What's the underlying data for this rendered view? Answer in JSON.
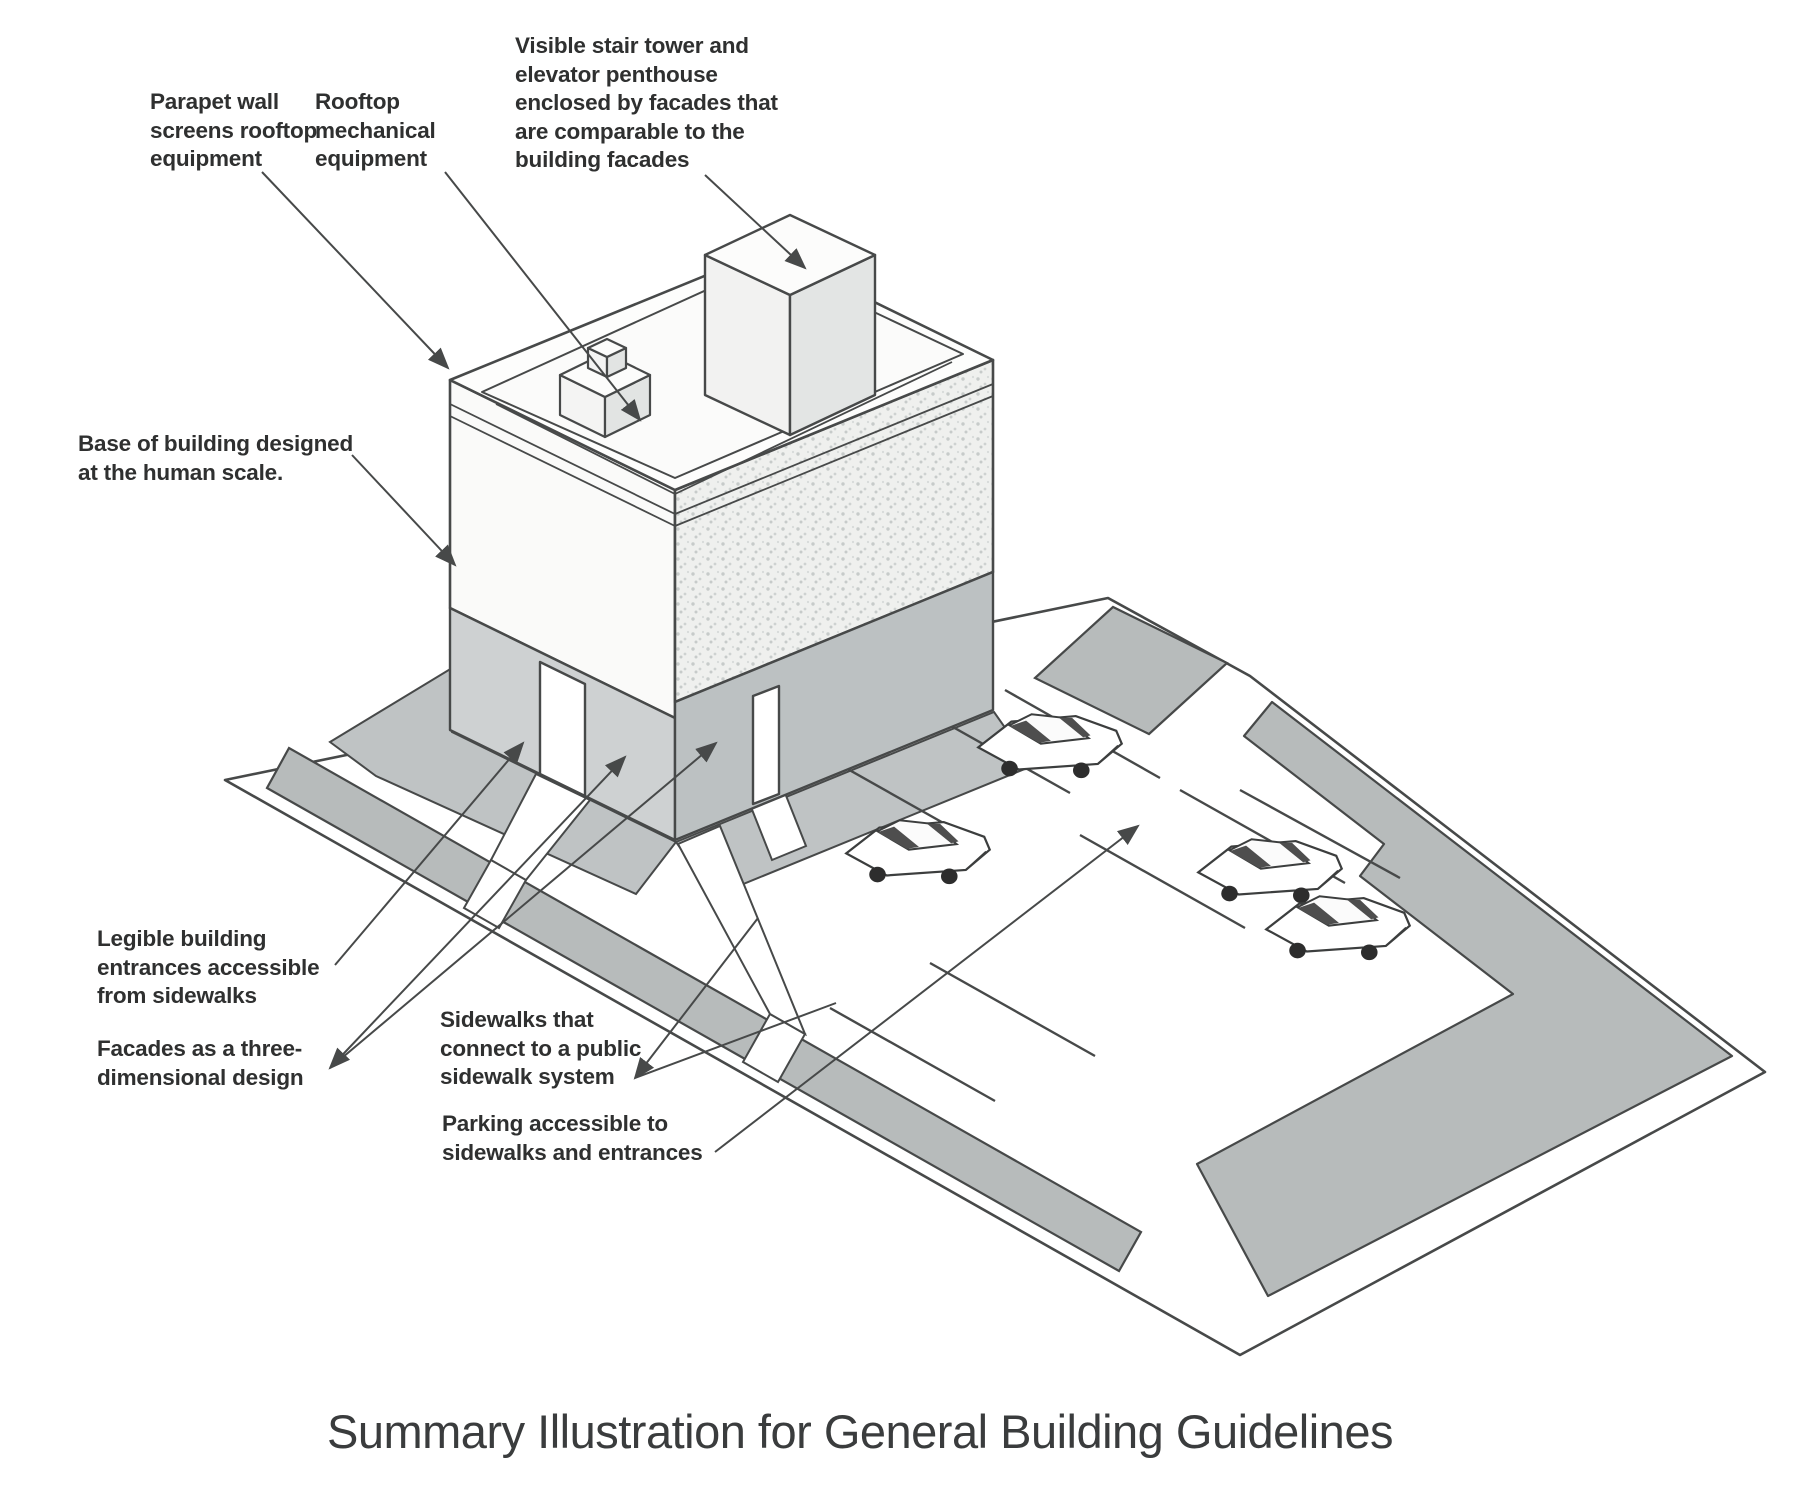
{
  "title": "Summary Illustration for General Building Guidelines",
  "labels": {
    "parapet": "Parapet wall\nscreens rooftop\nequipment",
    "rooftop_mech": "Rooftop\nmechanical\nequipment",
    "stair_tower": "Visible stair tower and\nelevator penthouse\nenclosed by facades that\nare comparable to the\nbuilding facades",
    "base_human_scale": "Base of building designed\nat the human scale.",
    "entrances": "Legible building\nentrances accessible\nfrom sidewalks",
    "facades": "Facades as a three-\ndimensional design",
    "sidewalks": "Sidewalks that\nconnect to a public\nsidewalk system",
    "parking": "Parking accessible to\nsidewalks and entrances"
  },
  "colors": {
    "line": "#474949",
    "text": "#2f3030",
    "sidewalk_gray": "#b7bbbb",
    "apron_gray": "#bfc3c4",
    "base_band_left": "#ced1d2",
    "base_band_right": "#bcc1c2",
    "facade_texture": "#eff0ee",
    "car_window": "#4e4e4e",
    "paper": "#ffffff"
  }
}
